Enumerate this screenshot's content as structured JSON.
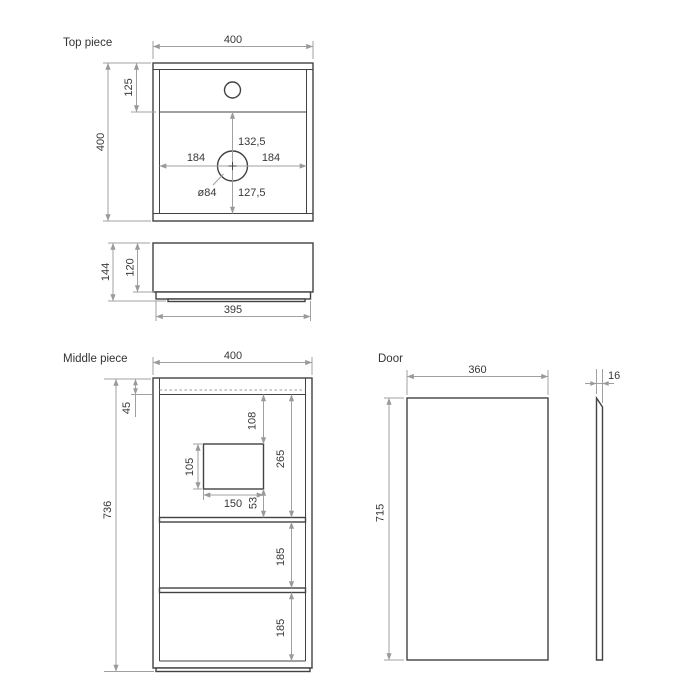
{
  "labels": {
    "top_piece": "Top piece",
    "middle_piece": "Middle piece",
    "door": "Door"
  },
  "top_piece": {
    "plan": {
      "width": "400",
      "height": "400",
      "hole_offset_from_top": "125",
      "center_to_divider": "132,5",
      "center_to_left": "184",
      "center_to_right": "184",
      "center_to_front": "127,5",
      "drain_hole_diameter": "ø84"
    },
    "side": {
      "total_height": "144",
      "body_height": "120",
      "base_width": "395"
    }
  },
  "middle_piece": {
    "width": "400",
    "total_height": "736",
    "top_rail_height": "45",
    "opening_from_top": "108",
    "opening_height": "105",
    "opening_width": "150",
    "opening_to_shelf": "53",
    "top_section_height": "265",
    "middle_section_height": "185",
    "bottom_section_height": "185"
  },
  "door": {
    "width": "360",
    "height": "715",
    "thickness": "16"
  },
  "colors": {
    "edge_line": "#424242",
    "dimension_line": "#a0a0a0",
    "text": "#383838",
    "background": "#ffffff"
  }
}
